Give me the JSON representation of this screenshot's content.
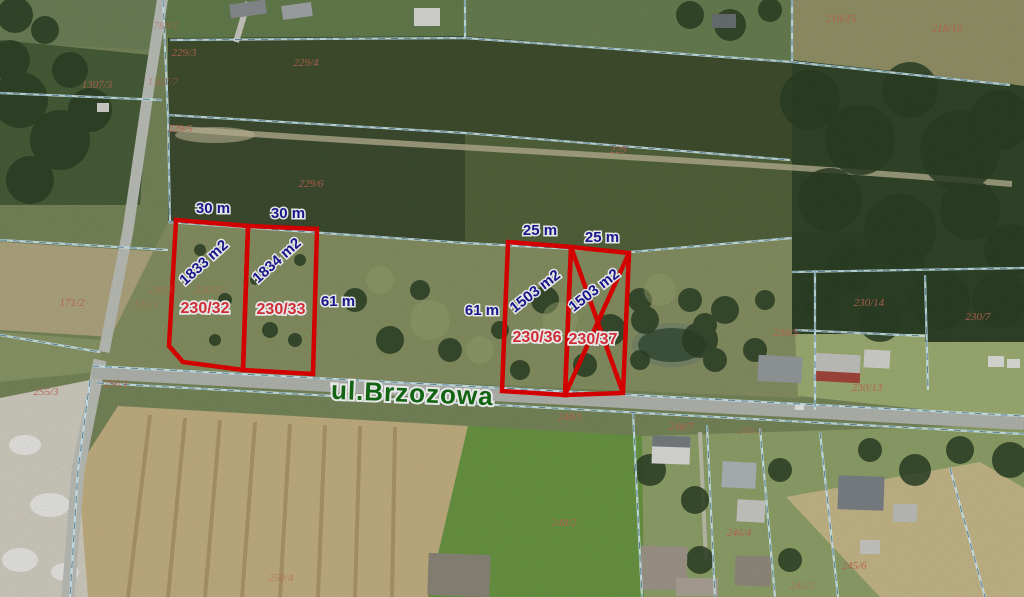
{
  "map": {
    "street": {
      "name": "ul.Brzozowa"
    },
    "plots": [
      {
        "number": "230/32",
        "area": "1833 m2",
        "status": "available"
      },
      {
        "number": "230/33",
        "area": "1834 m2",
        "status": "available"
      },
      {
        "number": "230/36",
        "area": "1503 m2",
        "status": "available"
      },
      {
        "number": "230/37",
        "area": "1503 m2",
        "status": "crossed-out"
      }
    ],
    "dimension_labels": [
      "30 m",
      "30 m",
      "25 m",
      "25 m",
      "61 m",
      "61 m"
    ],
    "cadastral_labels": [
      "788/1",
      "229/3",
      "1307/3",
      "1307/7",
      "229/4",
      "229/5",
      "229/6",
      "229",
      "218/15",
      "218/16",
      "171/2",
      "171/1",
      "230/31",
      "230/32",
      "230/14",
      "230/7",
      "230/5",
      "230/13",
      "256/1",
      "255/3",
      "248/1",
      "248/7",
      "246/2",
      "248/2",
      "246/4",
      "245/6",
      "245/2",
      "250/4"
    ],
    "colors": {
      "plot_outline": "#ea0000",
      "dimension_text": "#1b1b9a",
      "area_text": "#1b1b9a",
      "plot_number_text": "#e6333c",
      "cadastral_text": "#c86a58",
      "street_text": "#156f15",
      "boundary_line": "#bfe9f2"
    }
  }
}
